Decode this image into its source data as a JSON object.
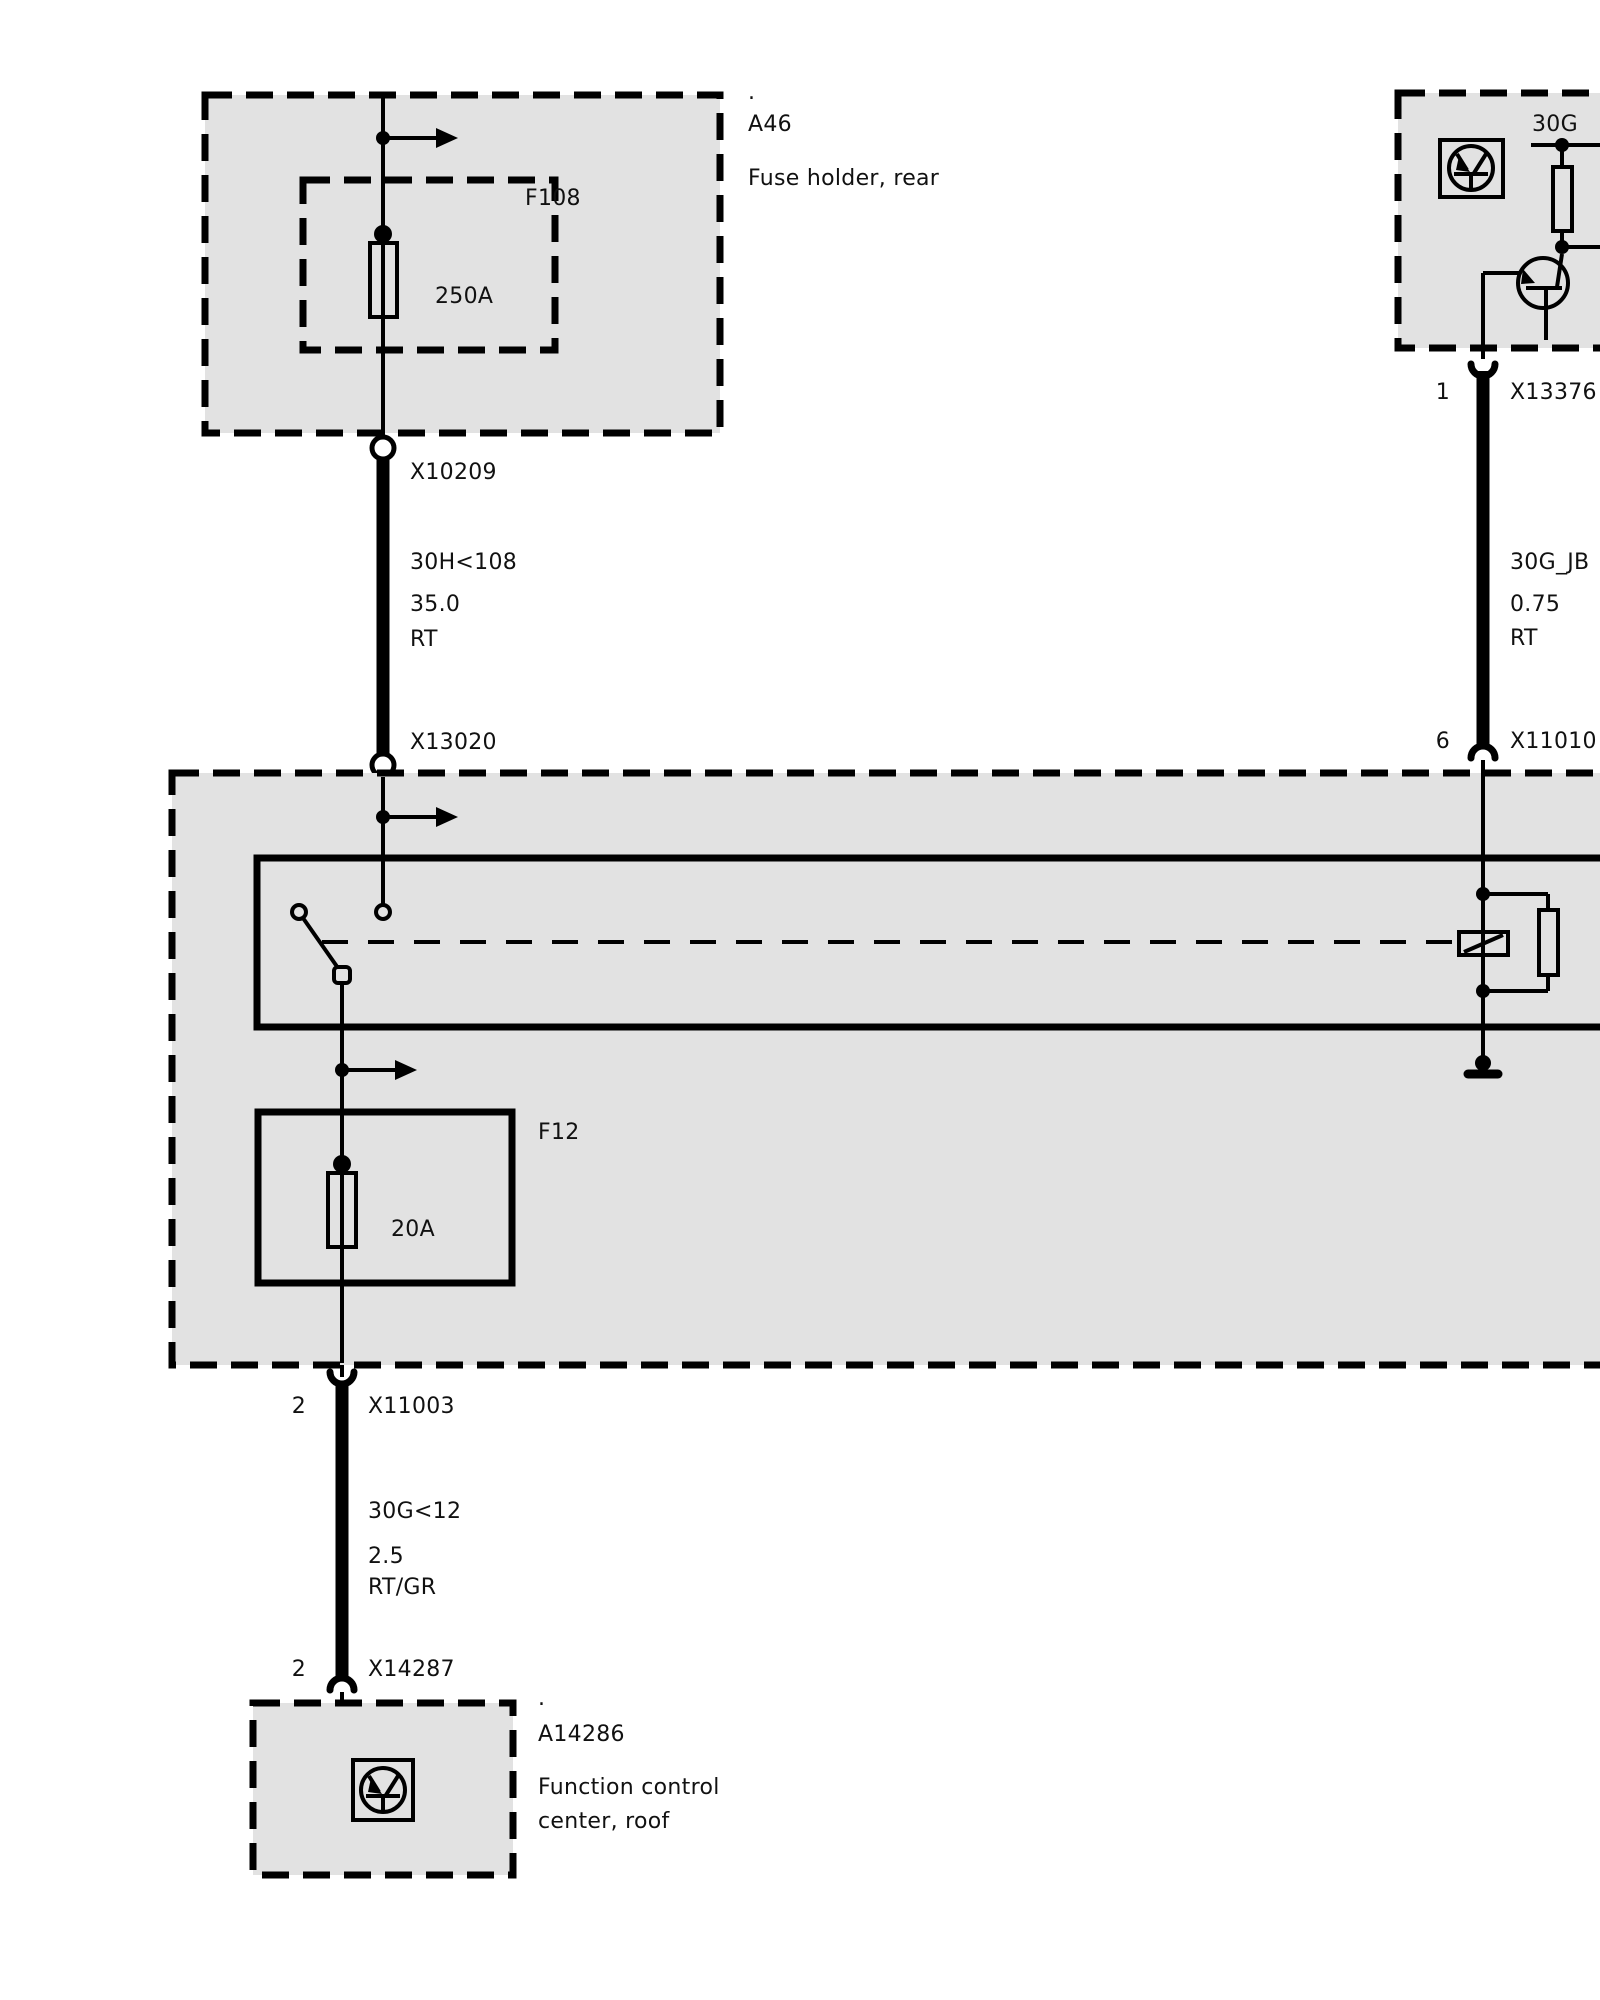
{
  "meta": {
    "background": "#ffffff",
    "box_fill": "#e2e2e2",
    "line_color": "#000000"
  },
  "components": {
    "a46": {
      "ref_dot": ".",
      "ref": "A46",
      "desc": "Fuse holder, rear",
      "fuse_ref": "F108",
      "fuse_rating": "250A"
    },
    "main_box": {
      "fuse_ref": "F12",
      "fuse_rating": "20A"
    },
    "roof_module": {
      "ref_dot": ".",
      "ref": "A14286",
      "desc_line1": "Function control",
      "desc_line2": "center, roof"
    },
    "power_module": {
      "bus_label": "30G"
    }
  },
  "connectors": {
    "x10209": {
      "label": "X10209"
    },
    "x13020": {
      "label": "X13020"
    },
    "x11003": {
      "pin": "2",
      "label": "X11003"
    },
    "x14287": {
      "pin": "2",
      "label": "X14287"
    },
    "x13376": {
      "pin": "1",
      "label": "X13376"
    },
    "x11010": {
      "pin": "6",
      "label": "X11010"
    }
  },
  "wires": {
    "left_upper": {
      "circuit": "30H<108",
      "gauge": "35.0",
      "color": "RT"
    },
    "left_lower": {
      "circuit": "30G<12",
      "gauge": "2.5",
      "color": "RT/GR"
    },
    "right": {
      "circuit": "30G_JB",
      "gauge": "0.75",
      "color": "RT"
    }
  }
}
